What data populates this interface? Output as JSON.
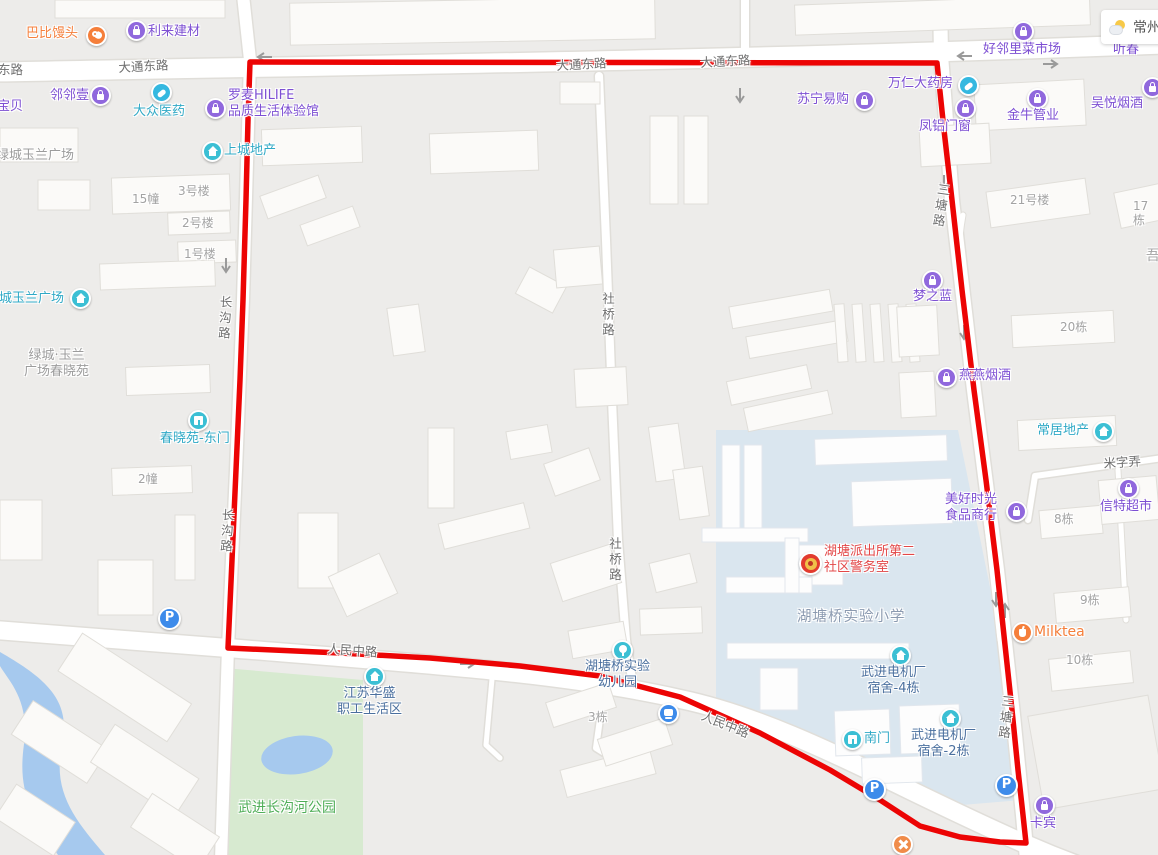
{
  "weather": {
    "city": "常州"
  },
  "roads": {
    "datong": "大通东路",
    "datong_partial": "东路",
    "shequiao": "社桥路",
    "changgou": "长沟路",
    "santang": "三塘路",
    "renmin": "人民中路",
    "mizi": "米字弄"
  },
  "pois": {
    "babi": {
      "label": "巴比馒头"
    },
    "lilai": {
      "label": "利来建材"
    },
    "haolinli": {
      "label": "好邻里菜市场"
    },
    "baobei": {
      "label": "宝贝"
    },
    "linlinyi": {
      "label": "邻邻壹"
    },
    "dazhong": {
      "label": "大众医药"
    },
    "luomai": {
      "label": "罗麦HILIFE\n品质生活体验馆"
    },
    "shangcheng": {
      "label": "上城地产"
    },
    "suning": {
      "label": "苏宁易购"
    },
    "wanren": {
      "label": "万仁大药房"
    },
    "fenglv": {
      "label": "凤铝门窗"
    },
    "jinniu": {
      "label": "金牛管业"
    },
    "wuyue": {
      "label": "吴悦烟酒"
    },
    "tingchun": {
      "label": "听春"
    },
    "lvcheng_plaza": {
      "label": "绿城玉兰广场"
    },
    "lvcheng_chunxiao": {
      "label": "绿城·玉兰\n广场春晓苑"
    },
    "chunxiao_gate": {
      "label": "春晓苑-东门"
    },
    "mengzhilan": {
      "label": "梦之蓝"
    },
    "yanyan": {
      "label": "燕燕烟酒"
    },
    "changju": {
      "label": "常居地产"
    },
    "meihao": {
      "label": "美好时光\n食品商行"
    },
    "xinte": {
      "label": "信特超市"
    },
    "milktea": {
      "label": "Milktea"
    },
    "police": {
      "label": "湖塘派出所第二\n社区警务室"
    },
    "school": {
      "label": "湖塘桥实验小学"
    },
    "dorm4": {
      "label": "武进电机厂\n宿舍-4栋"
    },
    "dorm2": {
      "label": "武进电机厂\n宿舍-2栋"
    },
    "nanmen": {
      "label": "南门"
    },
    "kabin": {
      "label": "卡宾"
    },
    "kindergarten": {
      "label": "湖塘桥实验\n幼儿园"
    },
    "jiangsu": {
      "label": "江苏华盛\n职工生活区"
    },
    "park": {
      "label": "武进长沟河公园"
    }
  },
  "buildings": {
    "b15": "15幢",
    "no3": "3号楼",
    "no2": "2号楼",
    "no1": "1号楼",
    "b2": "2幢",
    "no21": "21号楼",
    "d17": "17栋",
    "wu": "吾",
    "d20": "20栋",
    "d8": "8栋",
    "d9": "9栋",
    "d10": "10栋",
    "d3": "3栋"
  },
  "colors": {
    "boundary": "#ec0404",
    "poi_purple": "#7d4fd3",
    "poi_teal": "#2fa9c6",
    "residential_blue": "#4a6f9e",
    "police_red": "#e34747",
    "park_green": "#4fae57",
    "accent_orange": "#f57f3b"
  }
}
